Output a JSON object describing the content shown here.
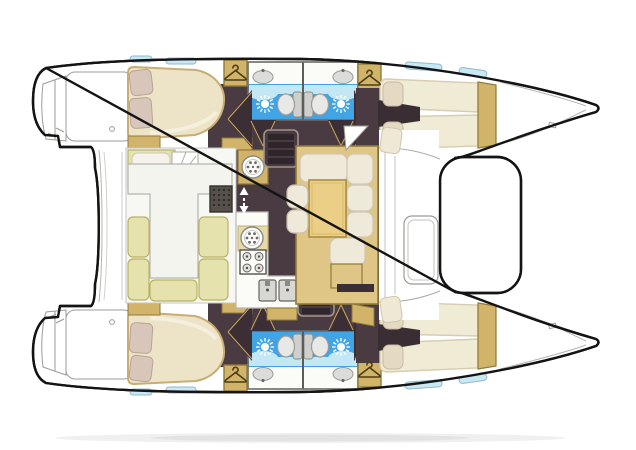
{
  "diagram": {
    "kind": "catamaran-interior-floor-plan-top-view",
    "rooms": {
      "portAftCabin": "port aft double cabin",
      "portForwardCabin": "port forward double berth cabin",
      "portHeads": "port bathrooms: shower, toilet, washbasin",
      "starboardHull": "starboard hull: aft cabin, two bathrooms, forward cabin",
      "saloon": "saloon lounge with L-sofa and table",
      "galley": "galley with burners and twin sinks",
      "cockpitDinette": "aft dinette with U-settee and table",
      "foredeck": "foredeck with locker hatch",
      "bowPort": "port bow",
      "bowStarboard": "starboard bow",
      "transomPort": "port transom steps",
      "transomStarboard": "starboard transom steps"
    },
    "icons": {
      "shower": "sun-shower-icon",
      "toilet": "toilet-icon",
      "washbasin": "washbasin-icon",
      "stove": "four-burner-stove-icon",
      "doubleSink": "double-sink-icon",
      "roundHatch": "round-hatch-icon",
      "wardrobe": "clothes-hanger-icon",
      "steps": "companionway-steps-icon",
      "stairsArrows": "up-down-arrows-icon",
      "grate": "vent-grate-icon",
      "door": "door-swing-icon",
      "window": "hull-window-icon"
    },
    "colors": {
      "outline": "#141414",
      "floorPlum": "#4a3a41",
      "floorPlumDark": "#3a2d33",
      "gold": "#d2b36a",
      "goldLight": "#dfc687",
      "goldBorder": "#8f7a3a",
      "creamCushion": "#efe9d9",
      "berthCream": "#f0ebd4",
      "bedBeige": "#ede4c8",
      "pillowPink": "#d9c6ba",
      "setteePale": "#e6e2ae",
      "tableTan": "#eccf86",
      "bathBlue": "#41a4e4",
      "bathBlueLight": "#c4e7f6",
      "windowBlue": "#c8e8f4",
      "toiletGray": "#d6d6d3",
      "detailGray": "#9b9b97"
    }
  }
}
